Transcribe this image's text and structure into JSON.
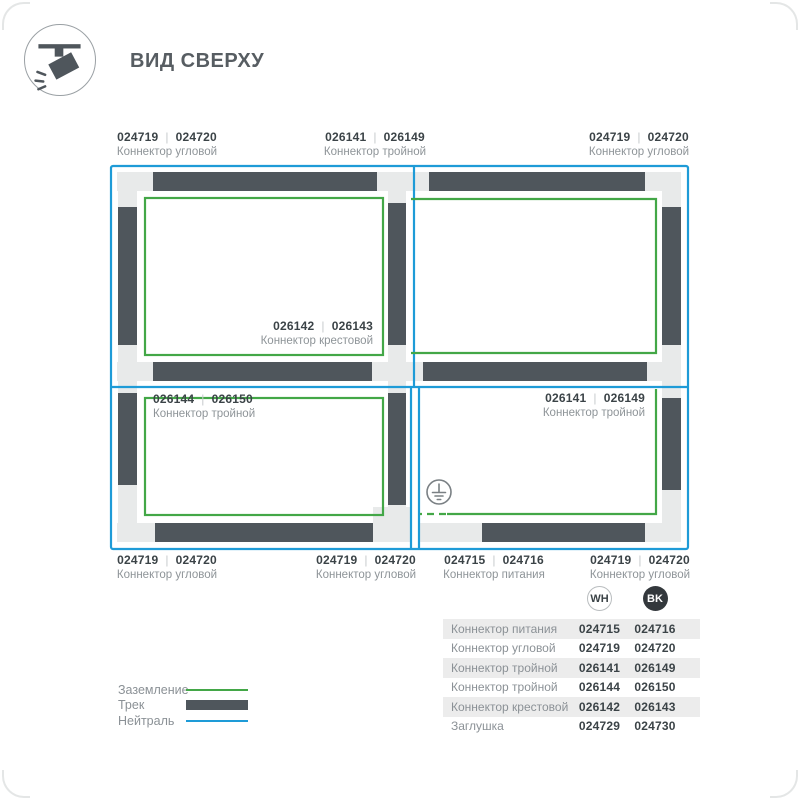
{
  "header": {
    "title": "ВИД СВЕРХУ",
    "icon": "track-spotlight-icon"
  },
  "colors": {
    "neutral_blue": "#1e9bd7",
    "ground_green": "#43a747",
    "track_dark": "#4f565c",
    "connector_base": "#e8eaea",
    "text_dark": "#3b4347",
    "text_gray": "#8e9498",
    "table_stripe": "#ececec",
    "bk_badge": "#33383c"
  },
  "diagram": {
    "separator": "|",
    "connector_labels": [
      {
        "id": "top-left",
        "wh": "024719",
        "bk": "024720",
        "name": "Коннектор угловой",
        "x": 167,
        "y": 130,
        "align": "center"
      },
      {
        "id": "top-center",
        "wh": "026141",
        "bk": "026149",
        "name": "Коннектор тройной",
        "x": 375,
        "y": 130,
        "align": "center"
      },
      {
        "id": "top-right",
        "wh": "024719",
        "bk": "024720",
        "name": "Коннектор угловой",
        "x": 639,
        "y": 130,
        "align": "center"
      },
      {
        "id": "center-cross",
        "wh": "026142",
        "bk": "026143",
        "name": "Коннектор крестовой",
        "x": 373,
        "y": 319,
        "align": "right"
      },
      {
        "id": "mid-left",
        "wh": "026144",
        "bk": "026150",
        "name": "Коннектор тройной",
        "x": 153,
        "y": 392,
        "align": "left"
      },
      {
        "id": "mid-right",
        "wh": "026141",
        "bk": "026149",
        "name": "Коннектор тройной",
        "x": 645,
        "y": 391,
        "align": "right"
      },
      {
        "id": "bottom-left",
        "wh": "024719",
        "bk": "024720",
        "name": "Коннектор угловой",
        "x": 167,
        "y": 553,
        "align": "center"
      },
      {
        "id": "bottom-center",
        "wh": "024719",
        "bk": "024720",
        "name": "Коннектор угловой",
        "x": 366,
        "y": 553,
        "align": "center"
      },
      {
        "id": "bottom-power",
        "wh": "024715",
        "bk": "024716",
        "name": "Коннектор питания",
        "x": 494,
        "y": 553,
        "align": "center"
      },
      {
        "id": "bottom-right",
        "wh": "024719",
        "bk": "024720",
        "name": "Коннектор угловой",
        "x": 640,
        "y": 553,
        "align": "center"
      }
    ]
  },
  "legend": {
    "items": [
      {
        "label": "Заземление",
        "swatch": "ground-line"
      },
      {
        "label": "Трек",
        "swatch": "track-bar"
      },
      {
        "label": "Нейтраль",
        "swatch": "neutral-line"
      }
    ]
  },
  "table": {
    "columns": [
      {
        "code": "WH"
      },
      {
        "code": "BK"
      }
    ],
    "rows": [
      {
        "name": "Коннектор питания",
        "wh": "024715",
        "bk": "024716"
      },
      {
        "name": "Коннектор угловой",
        "wh": "024719",
        "bk": "024720"
      },
      {
        "name": "Коннектор тройной",
        "wh": "026141",
        "bk": "026149"
      },
      {
        "name": "Коннектор тройной",
        "wh": "026144",
        "bk": "026150"
      },
      {
        "name": "Коннектор крестовой",
        "wh": "026142",
        "bk": "026143"
      },
      {
        "name": "Заглушка",
        "wh": "024729",
        "bk": "024730"
      }
    ]
  }
}
